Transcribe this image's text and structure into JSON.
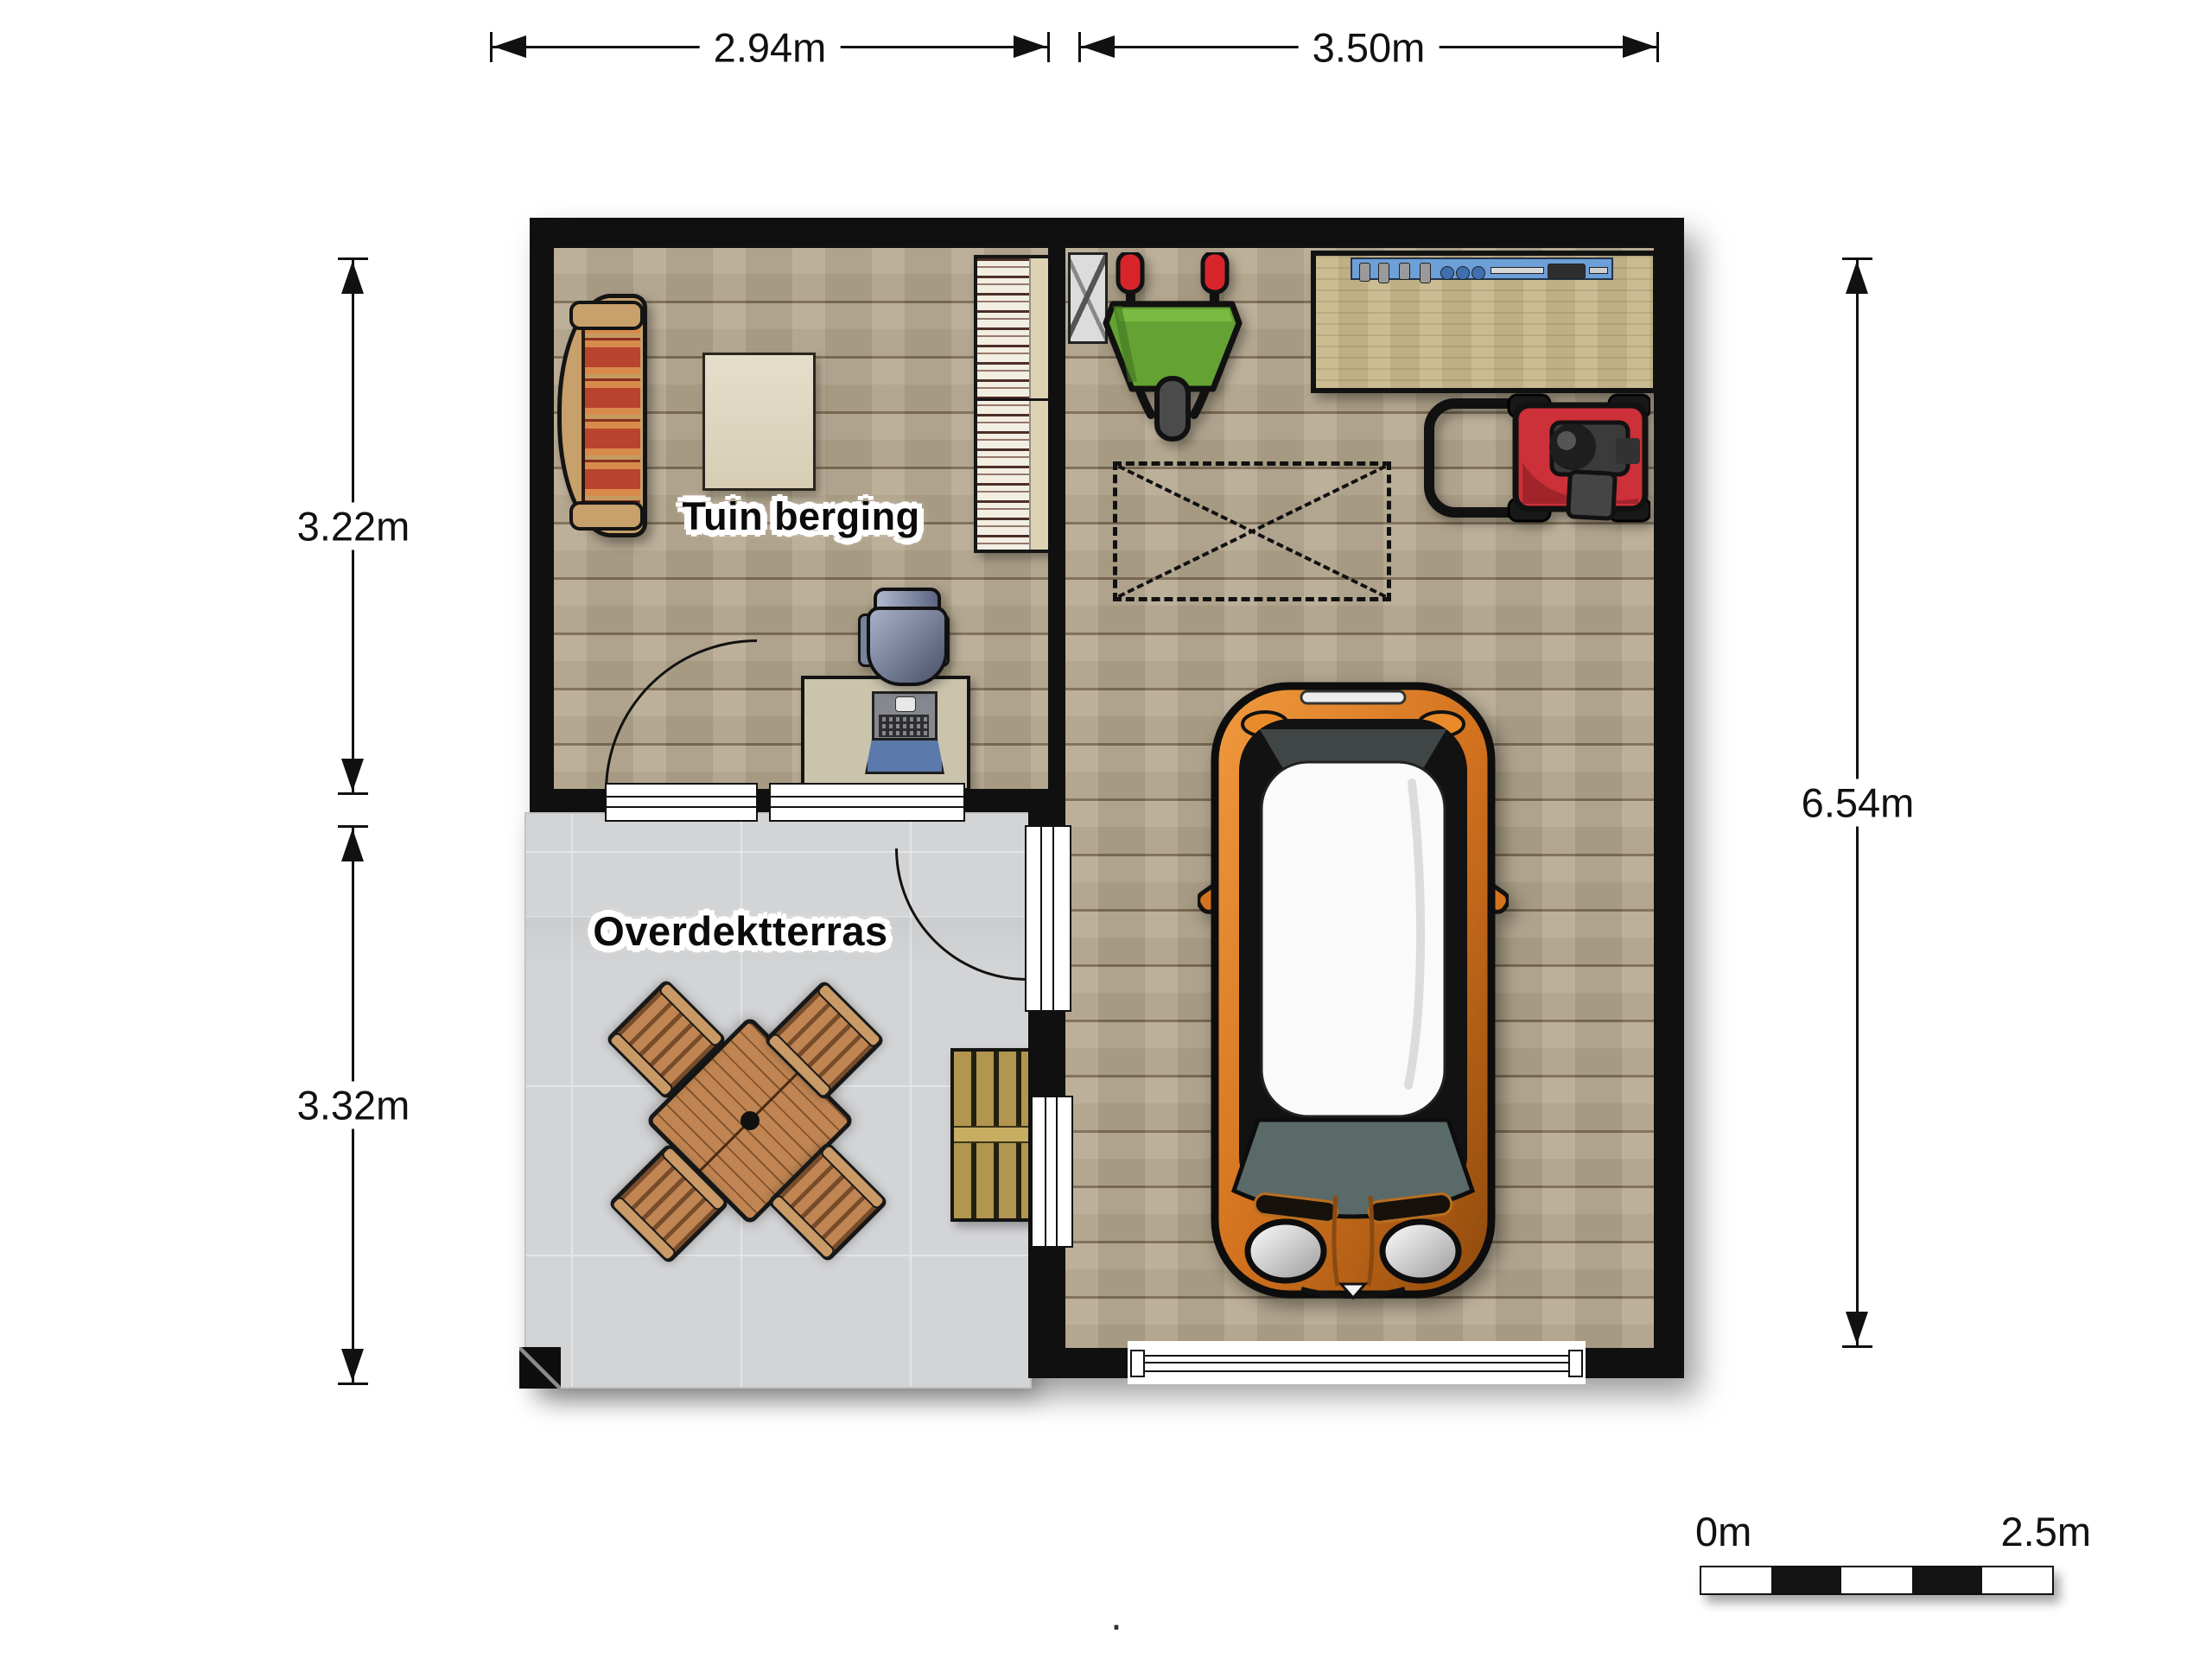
{
  "dimensions": {
    "top_left": "2.94m",
    "top_right": "3.50m",
    "left_upper": "3.22m",
    "left_lower": "3.32m",
    "right_side": "6.54m"
  },
  "rooms": {
    "storage": {
      "label": "Tuin berging"
    },
    "terrace": {
      "label": "Overdektterras"
    }
  },
  "scale_bar": {
    "start_label": "0m",
    "end_label": "2.5m"
  },
  "footnote": ".",
  "colors": {
    "wall": "#101010",
    "wood_floor": "#b5a78e",
    "terrace_floor": "#d3d4d6",
    "car_body": "#d4731f",
    "car_roof": "#fafafa",
    "mower_red": "#cc3038",
    "wheelbarrow_green": "#64a233",
    "tool_rail_blue": "#6d9fd8",
    "laptop_screen_blue": "#5b79aa",
    "sofa_stripe_red": "#b8432e",
    "sofa_stripe_orange": "#d88a4b",
    "patio_wood": "#c08552",
    "pallet_wood": "#b2964f"
  }
}
